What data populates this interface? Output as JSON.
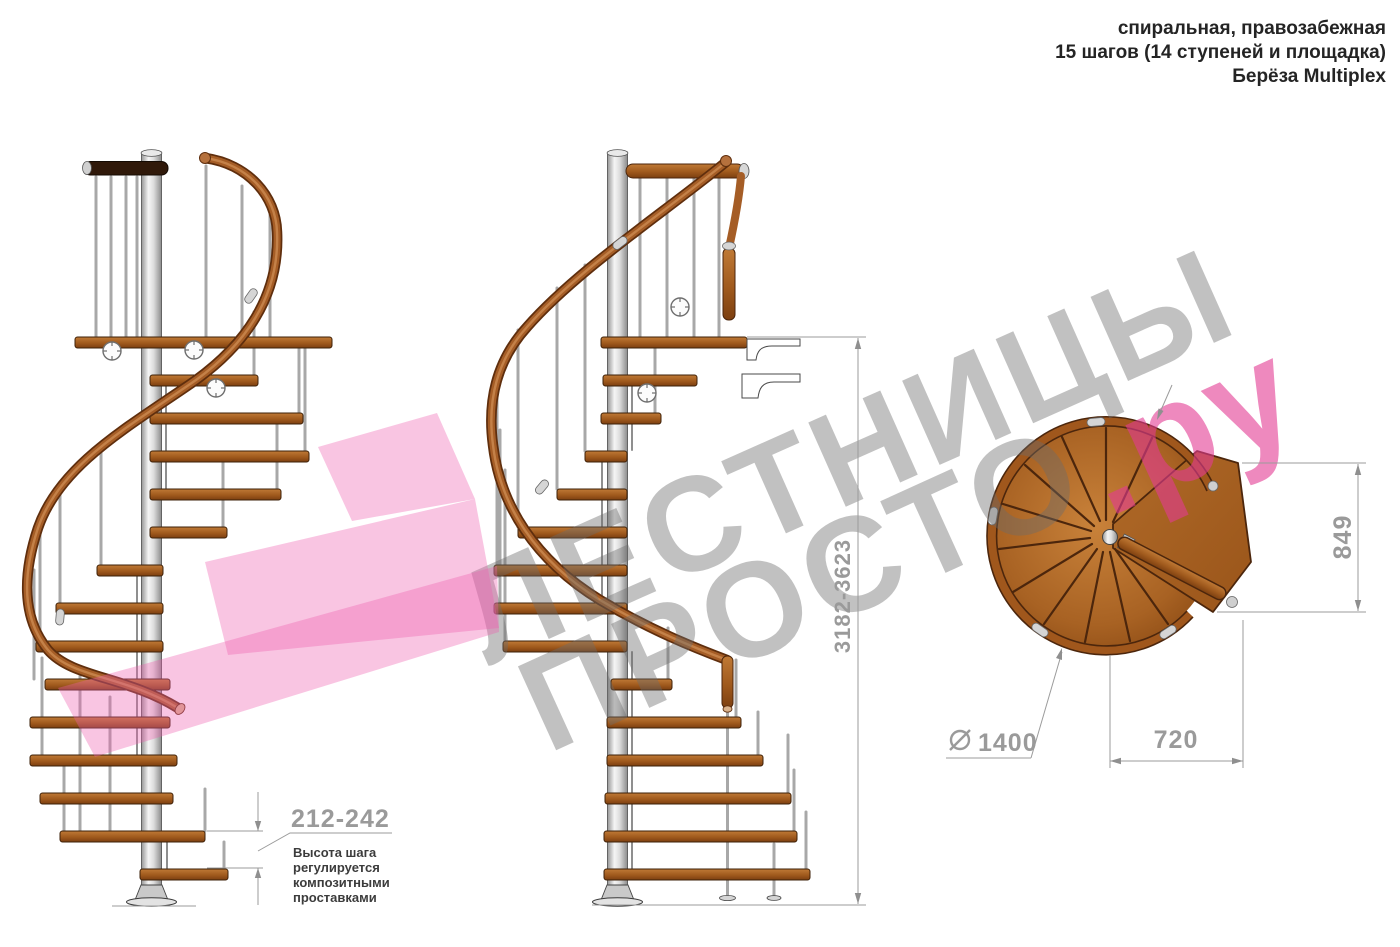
{
  "title_block": {
    "line1": "спиральная, правозабежная",
    "line2": "15 шагов (14 ступеней и площадка)",
    "line3": "Берёза Multiplex"
  },
  "watermark": {
    "line1": "ЛЕСТНИЦЫ",
    "line2": "ПРОСТО",
    "accent": ".ру",
    "gray_color": "#a8a8a8",
    "pink_color": "#e583b5",
    "band_color": "#ee5fae"
  },
  "dimensions": {
    "step_height": "212-242",
    "note_lines": [
      "Высота шага",
      "регулируется",
      "композитными",
      "проставками"
    ],
    "total_height": "3182-3623",
    "landing_depth": "849",
    "tread_run": "720",
    "diameter_symbol": "⌀",
    "diameter": "1400"
  },
  "colors": {
    "wood": "#a9611f",
    "wood_dark": "#4c260c",
    "handrail": "#a55d26",
    "pole": "#d9d9d9",
    "dim_line": "#9b9b9b",
    "dim_text": "#9a9a9a",
    "note_text": "#3c3c3c",
    "title_text": "#242424"
  }
}
